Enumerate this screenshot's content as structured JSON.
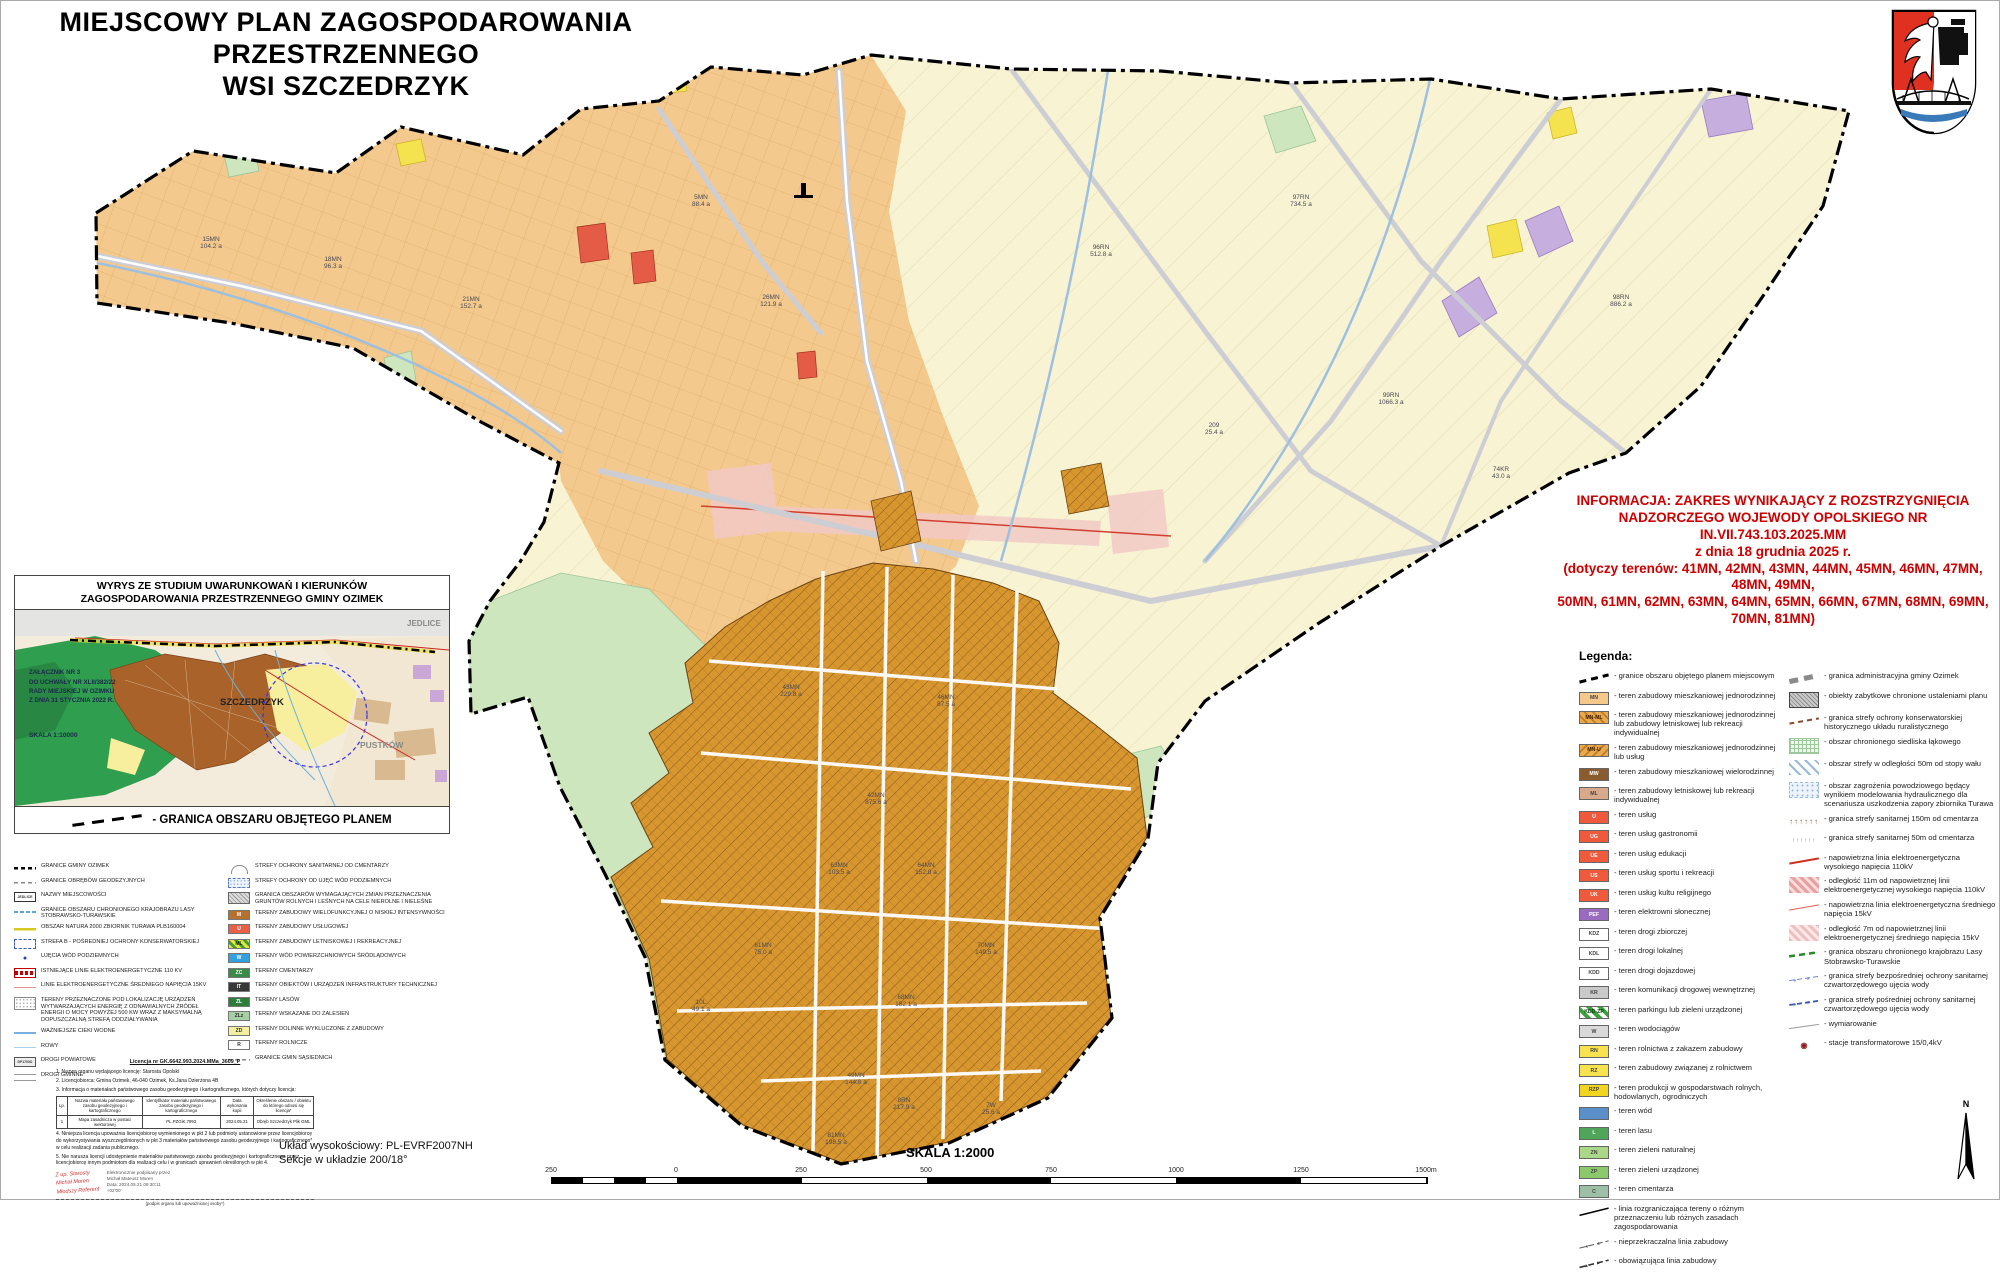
{
  "title": {
    "line1": "MIEJSCOWY PLAN ZAGOSPODAROWANIA PRZESTRZENNEGO",
    "line2": "WSI SZCZEDRZYK"
  },
  "info_box": {
    "color": "#cc0000",
    "lines": [
      {
        "t": "INFORMACJA: ZAKRES WYNIKAJĄCY Z ROZSTRZYGNIĘCIA"
      },
      {
        "t": "NADZORCZEGO WOJEWODY OPOLSKIEGO NR IN.VII.743.103.2025.MM"
      },
      {
        "t": "z dnia 18 grudnia 2025 r."
      },
      {
        "t": "(dotyczy terenów: 41MN, 42MN, 43MN, 44MN, 45MN, 46MN, 47MN, 48MN, 49MN,"
      },
      {
        "t": "50MN, 61MN, 62MN, 63MN, 64MN, 65MN, 66MN, 67MN, 68MN, 69MN, 70MN, 81MN)"
      }
    ]
  },
  "legend_right": {
    "heading": "Legenda:",
    "col1": [
      {
        "cls": "sym-plan-border",
        "code": "",
        "label": "- granice obszaru objętego planem miejscowym"
      },
      {
        "cls": "c-mn",
        "code": "MN",
        "label": "- teren zabudowy mieszkaniowej jednorodzinnej"
      },
      {
        "cls": "c-mnml",
        "code": "MN-ML",
        "label": "- teren zabudowy mieszkaniowej jednorodzinnej lub zabudowy letniskowej lub rekreacji indywidualnej"
      },
      {
        "cls": "c-mnu",
        "code": "MN-U",
        "label": "- teren zabudowy mieszkaniowej jednorodzinnej lub usług"
      },
      {
        "cls": "c-mw",
        "code": "MW",
        "label": "- teren zabudowy mieszkaniowej wielorodzinnej"
      },
      {
        "cls": "c-ml",
        "code": "ML",
        "label": "- teren zabudowy letniskowej lub rekreacji indywidualnej"
      },
      {
        "cls": "c-u",
        "code": "U",
        "label": "- teren usług"
      },
      {
        "cls": "c-u",
        "code": "UG",
        "label": "- teren usług gastronomii"
      },
      {
        "cls": "c-u",
        "code": "UE",
        "label": "- teren usług edukacji"
      },
      {
        "cls": "c-u",
        "code": "US",
        "label": "- teren usług sportu i rekreacji"
      },
      {
        "cls": "c-u",
        "code": "UK",
        "label": "- teren usług kultu religijnego"
      },
      {
        "cls": "c-pef",
        "code": "PEF",
        "label": "- teren elektrowni słonecznej"
      },
      {
        "cls": "c-kd",
        "code": "KDZ",
        "label": "- teren drogi zbiorczej"
      },
      {
        "cls": "c-kd",
        "code": "KDL",
        "label": "- teren drogi lokalnej"
      },
      {
        "cls": "c-kd",
        "code": "KDD",
        "label": "- teren drogi dojazdowej"
      },
      {
        "cls": "c-kr",
        "code": "KR",
        "label": "- teren komunikacji drogowej wewnętrznej"
      },
      {
        "cls": "c-kddzp",
        "code": "KDD-ZP",
        "label": "- teren parkingu lub zieleni urządzonej"
      },
      {
        "cls": "c-wdc",
        "code": "W",
        "label": "- teren wodociągów"
      },
      {
        "cls": "c-rn",
        "code": "RN",
        "label": "- teren rolnictwa z zakazem zabudowy"
      },
      {
        "cls": "c-rn",
        "code": "RZ",
        "label": "- teren zabudowy związanej z rolnictwem"
      },
      {
        "cls": "c-rzp",
        "code": "RZP",
        "label": "- teren produkcji w gospodarstwach rolnych, hodowlanych, ogrodniczych"
      },
      {
        "cls": "c-wod",
        "code": "",
        "label": "- teren wód"
      },
      {
        "cls": "c-las",
        "code": "L",
        "label": "- teren lasu"
      },
      {
        "cls": "c-zn",
        "code": "ZN",
        "label": "- teren zieleni naturalnej"
      },
      {
        "cls": "c-zp",
        "code": "ZP",
        "label": "- teren zieleni urządzonej"
      },
      {
        "cls": "c-cem",
        "code": "C",
        "label": "- teren cmentarza"
      },
      {
        "cls": "sym-rozgr",
        "code": "",
        "label": "- linia rozgraniczająca tereny o różnym przeznaczeniu lub różnych zasadach zagospodarowania"
      },
      {
        "cls": "sym-nieprzekr",
        "code": "",
        "label": "- nieprzekraczalna linia zabudowy"
      },
      {
        "cls": "sym-obow",
        "code": "",
        "label": "- obowiązująca linia zabudowy"
      }
    ],
    "col2": [
      {
        "cls": "sym-admin",
        "code": "",
        "label": "- granica administracyjna gminy Ozimek"
      },
      {
        "cls": "sym-zabytki",
        "code": "",
        "label": "- obiekty zabytkowe chronione ustaleniami planu"
      },
      {
        "cls": "sym-konserw",
        "code": "",
        "label": "- granica strefy ochrony konserwatorskiej historycznego układu ruralistycznego"
      },
      {
        "cls": "sym-siedlisko",
        "code": "",
        "label": "- obszar chronionego siedliska łąkowego"
      },
      {
        "cls": "sym-wal",
        "code": "",
        "label": "- obszar strefy w odległości 50m od stopy wału"
      },
      {
        "cls": "sym-powodz",
        "code": "",
        "label": "- obszar zagrożenia powodziowego będący wynikiem modelowania hydraulicznego dla scenariusza uszkodzenia zapory zbiornika Turawa"
      },
      {
        "cls": "sym-sanit150",
        "code": "",
        "label": "- granica strefy sanitarnej 150m od cmentarza"
      },
      {
        "cls": "sym-sanit50",
        "code": "",
        "label": "- granica strefy sanitarnej 50m od cmentarza"
      },
      {
        "cls": "sym-110kv",
        "code": "",
        "label": "- napowietrzna linia elektroenergetyczna wysokiego napięcia 110kV"
      },
      {
        "cls": "sym-buf110",
        "code": "",
        "label": "- odległość 11m od napowietrznej linii elektroenergetycznej wysokiego napięcia 110kV"
      },
      {
        "cls": "sym-15kv",
        "code": "",
        "label": "- napowietrzna linia elektroenergetyczna średniego napięcia 15kV"
      },
      {
        "cls": "sym-buf15",
        "code": "",
        "label": "- odległość 7m od napowietrznej linii elektroenergetycznej średniego napięcia 15kV"
      },
      {
        "cls": "sym-krajobraz",
        "code": "",
        "label": "- granica obszaru chronionego krajobrazu Lasy Stobrawsko-Turawskie"
      },
      {
        "cls": "sym-ujbezp",
        "code": "",
        "label": "- granica strefy bezpośredniej ochrony sanitarnej czwartorzędowego ujęcia wody"
      },
      {
        "cls": "sym-ujposr",
        "code": "",
        "label": "- granica strefy pośredniej ochrony sanitarnej czwartorzędowego ujęcia wody"
      },
      {
        "cls": "sym-wymiar",
        "code": "",
        "label": "- wymiarowanie"
      },
      {
        "cls": "sym-trafo",
        "code": "",
        "label": "- stacje transformatorowe 15/0,4kV"
      }
    ]
  },
  "inset": {
    "title_line1": "WYRYS ZE STUDIUM UWARUNKOWAŃ I KIERUNKÓW",
    "title_line2": "ZAGOSPODAROWANIA PRZESTRZENNEGO GMINY OZIMEK",
    "zalacznik": "ZAŁĄCZNIK NR 3\nDO UCHWAŁY NR XLII/382/22\nRADY MIEJSKIEJ W OZIMKU\nZ DNIA 31 STYCZNIA 2022 R.",
    "skala": "SKALA 1:10000",
    "label_szczedrzyk": "SZCZEDRZYK",
    "label_pustkow": "PUSTKÓW",
    "label_jedlice": "JEDLICE",
    "footer": "- GRANICA OBSZARU OBJĘTEGO PLANEM"
  },
  "legend_left": {
    "col1": [
      {
        "cls": "sym2-gmina",
        "code": "",
        "label": "GRANICE GMINY OZIMEK"
      },
      {
        "cls": "sym2-obreby",
        "code": "",
        "label": "GRANICE OBRĘBÓW GEODEZYJNYCH"
      },
      {
        "cls": "sym2-nazwy",
        "code": "JEDLICE",
        "label": "NAZWY MIEJSCOWOŚCI"
      },
      {
        "cls": "sym2-ochk",
        "code": "",
        "label": "GRANICE OBSZARU CHRONIONEGO KRAJOBRAZU LASY STOBRAWSKO-TURAWSKIE"
      },
      {
        "cls": "sym2-natura",
        "code": "",
        "label": "OBSZAR NATURA 2000 ZBIORNIK TURAWA PLB160004"
      },
      {
        "cls": "sym2-strefab",
        "code": "",
        "label": "STREFA B - POŚREDNIEJ OCHRONY KONSERWATORSKIEJ"
      },
      {
        "cls": "sym2-ujecia",
        "code": "",
        "label": "UJĘCIA WÓD PODZIEMNYCH"
      },
      {
        "cls": "sym2-istn110",
        "code": "",
        "label": "ISTNIEJĄCE LINIE ELEKTROENERGETYCZNE 110 KV"
      },
      {
        "cls": "sym2-sn15",
        "code": "",
        "label": "LINIE ELEKTROENERGETYCZNE ŚREDNIEGO NAPIĘCIA 15KV"
      },
      {
        "cls": "sym2-oze",
        "code": "",
        "label": "TERENY PRZEZNACZONE POD LOKALIZACJĘ URZĄDZEŃ WYTWARZAJĄCYCH ENERGIĘ Z ODNAWIALNYCH ŹRÓDEŁ ENERGII O MOCY POWYŻEJ 500 KW WRAZ Z MAKSYMALNĄ DOPUSZCZALNĄ STREFĄ ODDZIAŁYWANIA"
      },
      {
        "cls": "sym2-cieki",
        "code": "",
        "label": "WAŻNIEJSZE CIEKI WODNE"
      },
      {
        "cls": "sym2-rowy",
        "code": "",
        "label": "ROWY"
      },
      {
        "cls": "sym2-drogipow",
        "code": "DP1703O",
        "label": "DROGI POWIATOWE"
      },
      {
        "cls": "sym2-droggmin",
        "code": "",
        "label": "DROGI GMINNE"
      }
    ],
    "col2": [
      {
        "cls": "sym2-sanitcmen",
        "code": "",
        "label": "STREFY OCHRONY SANITARNEJ OD CMENTARZY"
      },
      {
        "cls": "sym2-ochrwod",
        "code": "",
        "label": "STREFY OCHRONY OD UJĘĆ WÓD PODZIEMNYCH"
      },
      {
        "cls": "sym2-zmiany",
        "code": "",
        "label": "GRANICA OBSZARÓW WYMAGAJĄCYCH ZMIAN PRZEZNACZENIA GRUNTÓW ROLNYCH I LEŚNYCH NA CELE NIEROLNE I NIELEŚNE"
      },
      {
        "cls": "c2-m",
        "code": "M",
        "label": "TERENY ZABUDOWY WIELOFUNKCYJNEJ O NISKIEJ INTENSYWNOŚCI"
      },
      {
        "cls": "c2-u",
        "code": "U",
        "label": "TERENY ZABUDOWY USŁUGOWEJ"
      },
      {
        "cls": "c2-ml",
        "code": "ML",
        "label": "TERENY ZABUDOWY LETNISKOWEJ I REKREACYJNEJ"
      },
      {
        "cls": "c2-w",
        "code": "W",
        "label": "TERENY WÓD POWIERZCHNIOWYCH ŚRÓDLĄDOWYCH"
      },
      {
        "cls": "c2-zc",
        "code": "ZC",
        "label": "TERENY CMENTARZY"
      },
      {
        "cls": "c2-it",
        "code": "IT",
        "label": "TERENY OBIEKTÓW I URZĄDZEŃ INFRASTRUKTURY TECHNICZNEJ"
      },
      {
        "cls": "c2-zl",
        "code": "ZL",
        "label": "TERENY LASÓW"
      },
      {
        "cls": "c2-zlz",
        "code": "ZLz",
        "label": "TERENY WSKAZANE DO ZALESIEŃ"
      },
      {
        "cls": "c2-zd",
        "code": "ZD",
        "label": "TERENY DOLINNE WYKLUCZONE Z ZABUDOWY"
      },
      {
        "cls": "c2-r",
        "code": "R",
        "label": "TERENY ROLNICZE"
      },
      {
        "cls": "sym2-obreby",
        "code": "",
        "label": "GRANICE GMIN SĄSIEDNICH"
      }
    ]
  },
  "license": {
    "title": "Licencja nr GK.6642.993.2024.MMa_3609_P",
    "p1": "1. Nazwa organu wydającego licencję: Starosta Opolski",
    "p2": "2. Licencjobiorca: Gmina Ozimek, 46-040 Ozimek, Ks.Jana Dzierżona 4B",
    "p3": "3. Informacja o materiałach państwowego zasobu geodezyjnego i kartograficznego, których dotyczy licencja:",
    "table": {
      "headers": [
        "Lp.",
        "Nazwa materiału państwowego zasobu geodezyjnego i kartograficznego",
        "Identyfikator materiału państwowego zasobu geodezyjnego i kartograficznego",
        "Data wykonania kopii",
        "Określenie obszaru / obiektu do którego odnosi się licencja*"
      ],
      "row": [
        "1",
        "Mapa zasadnicza w postaci wektorowej",
        "PL.PZGiK.7993",
        "2024.05.21",
        "Obręb Szczedrzyk Plik GML"
      ]
    },
    "p4": "4. Niniejsza licencja upoważnia licencjobiorcę wymienionego w pkt 2 lub podmioty ustanowione przez licencjobiorcę do wykorzystywania wyszczególnionych w pkt 3 materiałów państwowego zasobu geodezyjnego i kartograficznego* w celu realizacji zadania publicznego.",
    "p5": "5. Nie narusza licencji udostępnienie materiałów państwowego zasobu geodezyjnego i kartograficznego przez licencjobiorcę innym podmiotom dla realizacji celu i w granicach uprawnień określonych w pkt 4.",
    "stamp_red": "Z up. Starosty\nMichał Moren\nMłodszy Referent",
    "stamp_gray": "Elektronicznie podpisany przez\nMichał Mateusz Moren\nData: 2024.05.21 09:30:11\n+02'00'",
    "sig_caption": "(podpis organu lub upoważnionej osoby*)"
  },
  "footer": {
    "uklad_line1": "Układ wysokościowy: PL-EVRF2007NH",
    "uklad_line2": "Sekcje w układzie 200/18°",
    "skala": "SKALA 1:2000",
    "north_label": "N",
    "scalebar_labels": [
      {
        "t": "250",
        "x": 0
      },
      {
        "t": "0",
        "x": 125
      },
      {
        "t": "250",
        "x": 250
      },
      {
        "t": "500",
        "x": 375
      },
      {
        "t": "750",
        "x": 500
      },
      {
        "t": "1000",
        "x": 625
      },
      {
        "t": "1250",
        "x": 750
      },
      {
        "t": "1500m",
        "x": 875
      }
    ]
  },
  "map": {
    "colors": {
      "agriculture": "#f8f3d3",
      "residential": "#f3c98e",
      "residential_ml": "#d8962f",
      "green_natural": "#cde6bd",
      "forest": "#58a95c",
      "solar_pef": "#c6aede",
      "services": "#e45c45",
      "farm_yellow": "#f4e34e",
      "power_buffer_pink": "#f2c9c6",
      "water": "#8fb4da",
      "road": "#cdcdd4",
      "boundary": "#000000"
    },
    "parcel_labels": [
      {
        "t": "15MN\n104.2 a",
        "x": 210,
        "y": 242
      },
      {
        "t": "18MN\n96.3 a",
        "x": 332,
        "y": 262
      },
      {
        "t": "21MN\n152.7 a",
        "x": 470,
        "y": 302
      },
      {
        "t": "5MN\n88.4 a",
        "x": 700,
        "y": 200
      },
      {
        "t": "26MN\n121.9 a",
        "x": 770,
        "y": 300
      },
      {
        "t": "96RN\n512.8 a",
        "x": 1100,
        "y": 250
      },
      {
        "t": "97RN\n734.5 a",
        "x": 1300,
        "y": 200
      },
      {
        "t": "98RN\n886.2 a",
        "x": 1620,
        "y": 300
      },
      {
        "t": "99RN\n1066.3 a",
        "x": 1390,
        "y": 398
      },
      {
        "t": "74KR\n43.0 a",
        "x": 1500,
        "y": 472
      },
      {
        "t": "209\n25.4 a",
        "x": 1213,
        "y": 428
      },
      {
        "t": "43MN\n229.8 a",
        "x": 790,
        "y": 690
      },
      {
        "t": "46MN\n87.5 a",
        "x": 945,
        "y": 700
      },
      {
        "t": "42MN\n875.6 a",
        "x": 875,
        "y": 798
      },
      {
        "t": "63MN\n103.5 a",
        "x": 838,
        "y": 868
      },
      {
        "t": "64MN\n152.8 a",
        "x": 925,
        "y": 868
      },
      {
        "t": "61MN\n75.0 a",
        "x": 762,
        "y": 948
      },
      {
        "t": "70MN\n149.5 a",
        "x": 985,
        "y": 948
      },
      {
        "t": "68MN\n182.1 a",
        "x": 905,
        "y": 1000
      },
      {
        "t": "49MN\n144.8 a",
        "x": 855,
        "y": 1078
      },
      {
        "t": "81MN\n198.5 a",
        "x": 835,
        "y": 1138
      },
      {
        "t": "10L\n49.1 a",
        "x": 700,
        "y": 1005
      },
      {
        "t": "8RN\n217.9 a",
        "x": 903,
        "y": 1103
      },
      {
        "t": "7W\n25.6 a",
        "x": 990,
        "y": 1108
      }
    ]
  }
}
